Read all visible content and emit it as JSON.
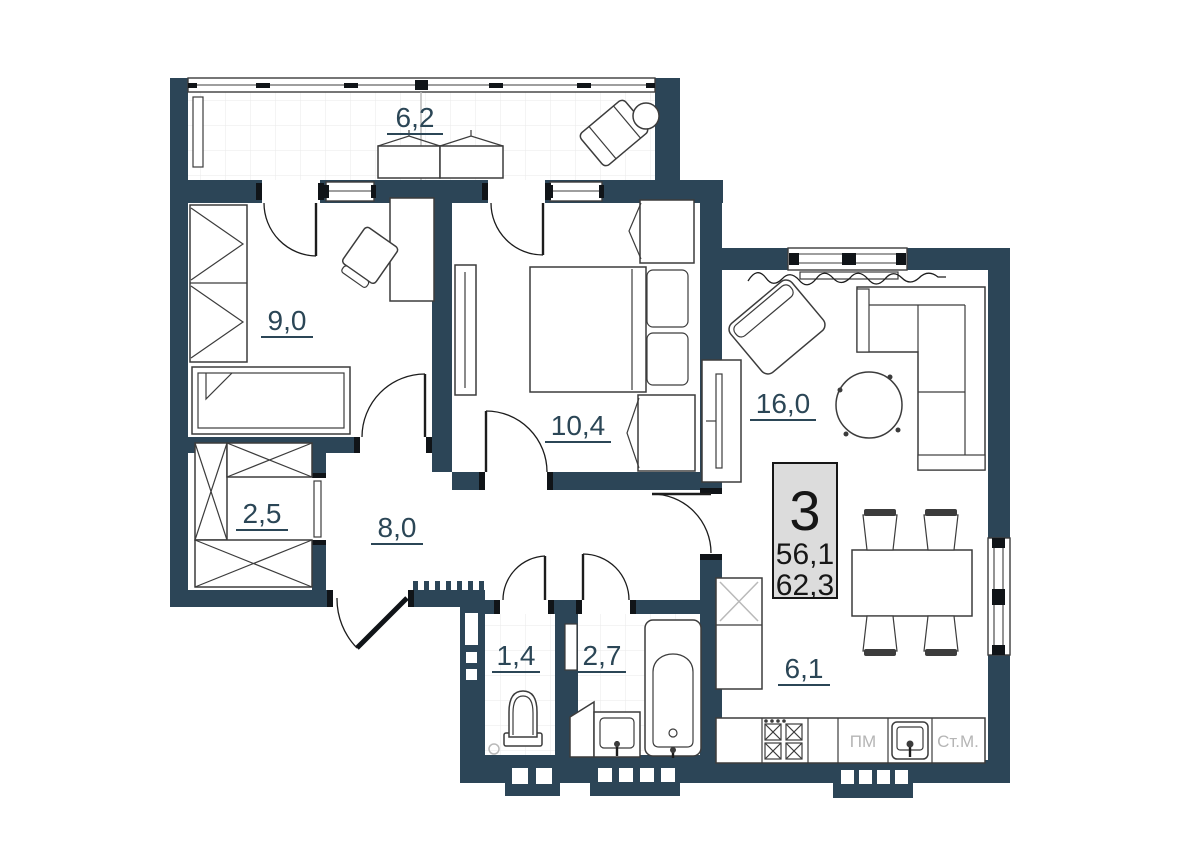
{
  "plan": {
    "type": "apartment-floor-plan",
    "colors": {
      "wall": "#2c4557",
      "label": "#2b4656",
      "muted_text": "#b5b5b5",
      "info_box_bg": "#dcdcdc"
    },
    "rooms": {
      "balcony": {
        "area": "6,2"
      },
      "bedroom_small": {
        "area": "9,0"
      },
      "bedroom_large": {
        "area": "10,4"
      },
      "living_room": {
        "area": "16,0"
      },
      "storage": {
        "area": "2,5"
      },
      "hallway": {
        "area": "8,0"
      },
      "wc": {
        "area": "1,4"
      },
      "bathroom": {
        "area": "2,7"
      },
      "kitchen": {
        "area": "6,1"
      }
    },
    "info_box": {
      "rooms_count": "3",
      "living_area": "56,1",
      "total_area": "62,3"
    },
    "appliance_labels": {
      "dishwasher": "ПМ",
      "washing_machine": "Ст.М."
    }
  }
}
